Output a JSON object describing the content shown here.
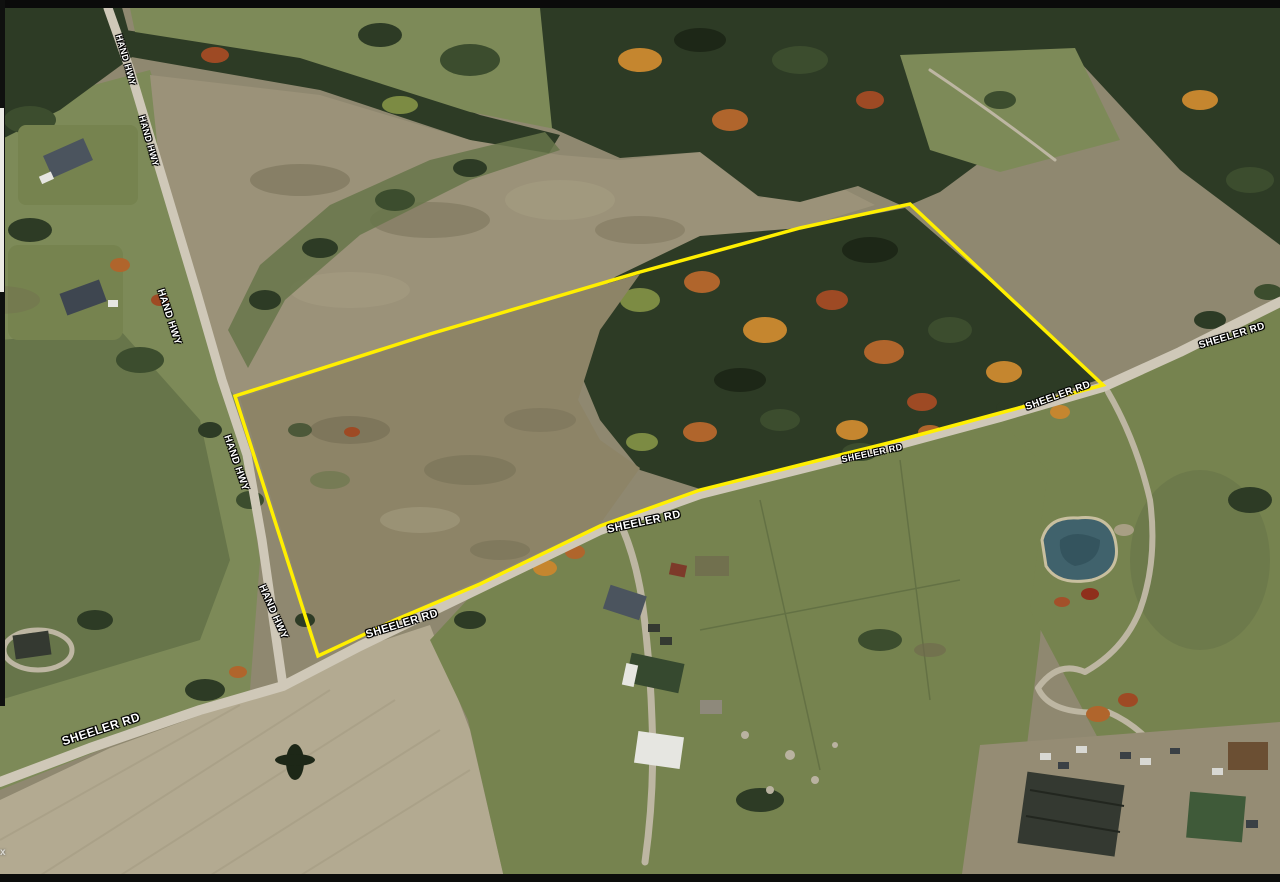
{
  "map": {
    "description": "aerial-satellite-view-with-parcel-outline",
    "road_labels": [
      {
        "text": "HAND HWY",
        "x": 126,
        "y": 60,
        "rot": 74,
        "size": 9
      },
      {
        "text": "HAND HWY",
        "x": 149,
        "y": 141,
        "rot": 74,
        "size": 9
      },
      {
        "text": "HAND HWY",
        "x": 169,
        "y": 317,
        "rot": 72,
        "size": 10
      },
      {
        "text": "HAND HWY",
        "x": 236,
        "y": 463,
        "rot": 71,
        "size": 10
      },
      {
        "text": "HAND HWY",
        "x": 273,
        "y": 612,
        "rot": 66,
        "size": 10
      },
      {
        "text": "SHEELER RD",
        "x": 101,
        "y": 729,
        "rot": -18,
        "size": 12
      },
      {
        "text": "SHEELER RD",
        "x": 402,
        "y": 624,
        "rot": -17,
        "size": 11
      },
      {
        "text": "SHEELER RD",
        "x": 644,
        "y": 522,
        "rot": -12,
        "size": 11
      },
      {
        "text": "SHEELER RD",
        "x": 872,
        "y": 453,
        "rot": -12,
        "size": 9
      },
      {
        "text": "SHEELER RD",
        "x": 1058,
        "y": 396,
        "rot": -20,
        "size": 10
      },
      {
        "text": "SHEELER RD",
        "x": 1232,
        "y": 336,
        "rot": -17,
        "size": 10
      }
    ],
    "parcel_outline": {
      "color": "#ffef00",
      "points": "235,396 430,334 640,272 800,228 910,204 1103,385 1000,413 900,440 800,465 700,490 600,526 480,584 395,620 318,656"
    },
    "edge_fragment_text": "x"
  }
}
